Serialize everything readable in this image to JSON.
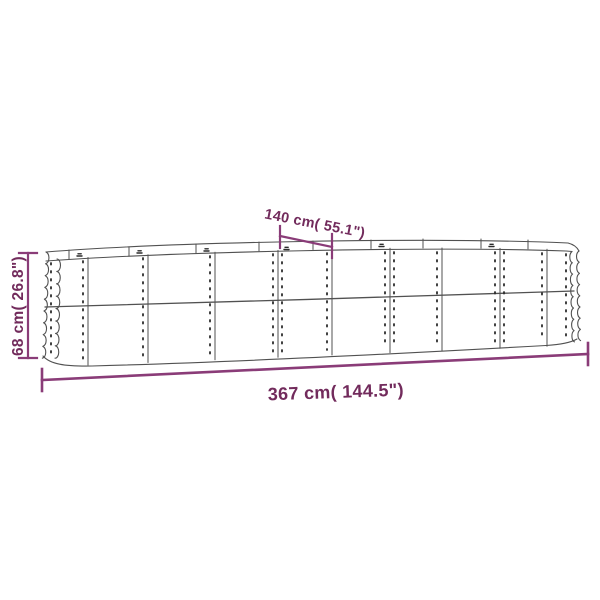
{
  "page": {
    "background": "#ffffff"
  },
  "diagram": {
    "kind": "raised-garden-bed-dimension-drawing",
    "labels": {
      "width": "140 cm( 55.1\")",
      "height": "68 cm( 26.8\")",
      "length": "367 cm( 144.5\")"
    },
    "colors": {
      "dimension_line": "#8a3c78",
      "dimension_text": "#722b5c",
      "drawing_line": "#515151",
      "rivet": "#2b2b2b",
      "background": "#ffffff"
    }
  }
}
